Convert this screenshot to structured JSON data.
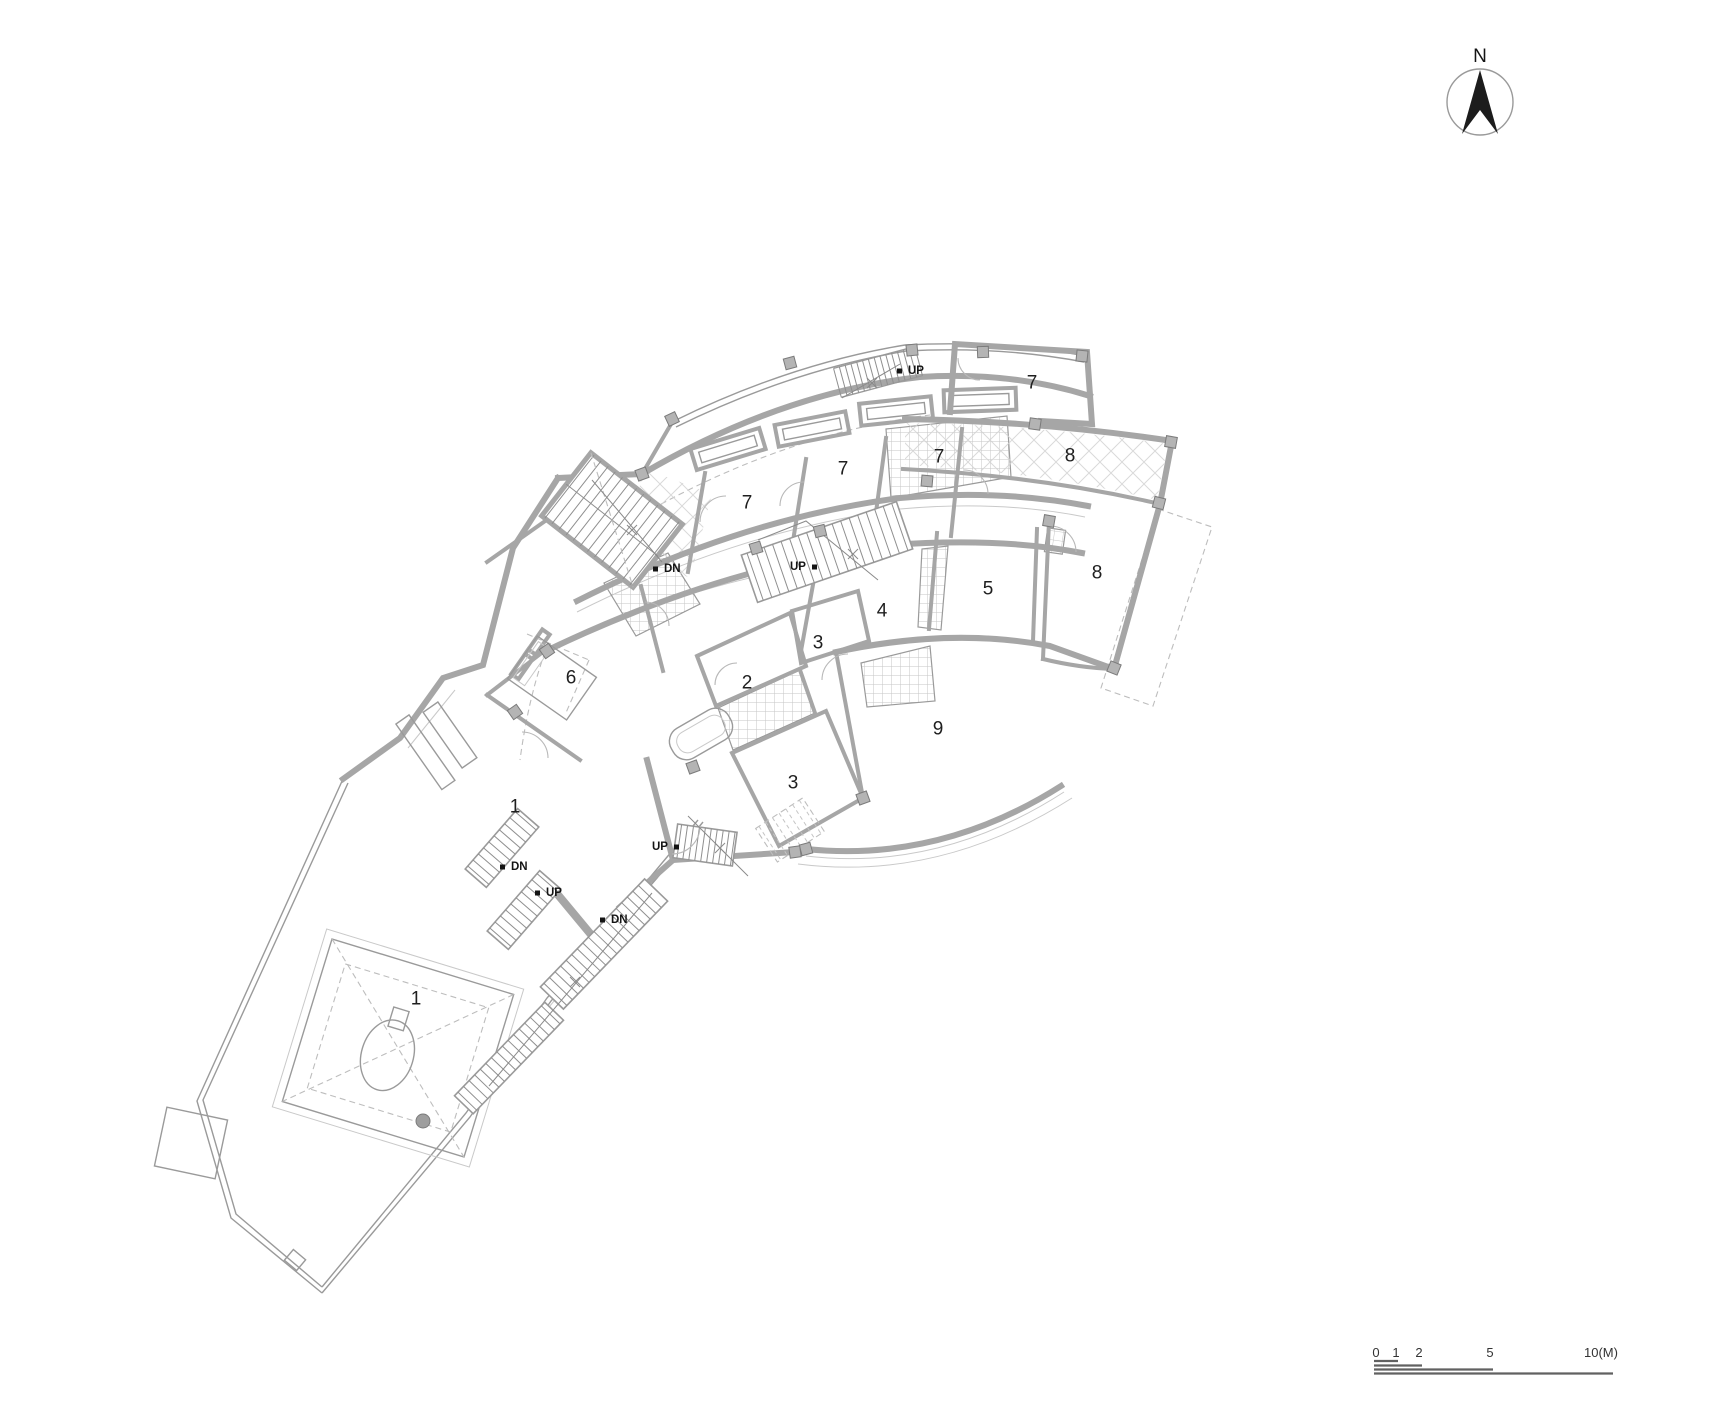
{
  "plan": {
    "rooms": [
      {
        "label": "7",
        "x": 747,
        "y": 503
      },
      {
        "label": "7",
        "x": 843,
        "y": 469
      },
      {
        "label": "7",
        "x": 939,
        "y": 457
      },
      {
        "label": "7",
        "x": 1032,
        "y": 383
      },
      {
        "label": "8",
        "x": 1070,
        "y": 456
      },
      {
        "label": "8",
        "x": 1097,
        "y": 573
      },
      {
        "label": "5",
        "x": 988,
        "y": 589
      },
      {
        "label": "4",
        "x": 882,
        "y": 611
      },
      {
        "label": "3",
        "x": 818,
        "y": 643
      },
      {
        "label": "2",
        "x": 747,
        "y": 683
      },
      {
        "label": "6",
        "x": 571,
        "y": 678
      },
      {
        "label": "3",
        "x": 793,
        "y": 783
      },
      {
        "label": "9",
        "x": 938,
        "y": 729
      },
      {
        "label": "1",
        "x": 515,
        "y": 807
      },
      {
        "label": "1",
        "x": 416,
        "y": 999
      }
    ],
    "stair_labels": [
      {
        "label": "UP",
        "x": 908,
        "y": 371,
        "dot": "left"
      },
      {
        "label": "DN",
        "x": 664,
        "y": 569,
        "dot": "left"
      },
      {
        "label": "UP",
        "x": 790,
        "y": 567,
        "dot": "right"
      },
      {
        "label": "UP",
        "x": 652,
        "y": 847,
        "dot": "right"
      },
      {
        "label": "DN",
        "x": 511,
        "y": 867,
        "dot": "left"
      },
      {
        "label": "UP",
        "x": 546,
        "y": 893,
        "dot": "left"
      },
      {
        "label": "DN",
        "x": 611,
        "y": 920,
        "dot": "left"
      }
    ],
    "compass": {
      "label": "N"
    },
    "scale_bar": {
      "labels": [
        {
          "text": "0",
          "x": 1376
        },
        {
          "text": "1",
          "x": 1396
        },
        {
          "text": "2",
          "x": 1419
        },
        {
          "text": "5",
          "x": 1490
        },
        {
          "text": "10(M)",
          "x": 1601
        }
      ]
    },
    "colors": {
      "wall": "#a6a6a6",
      "line": "#9a9a9a",
      "faint": "#c9c9c9",
      "dash": "#bdbdbd",
      "ink": "#1f1f1f",
      "north_arrow": "#1c1c1c"
    }
  }
}
